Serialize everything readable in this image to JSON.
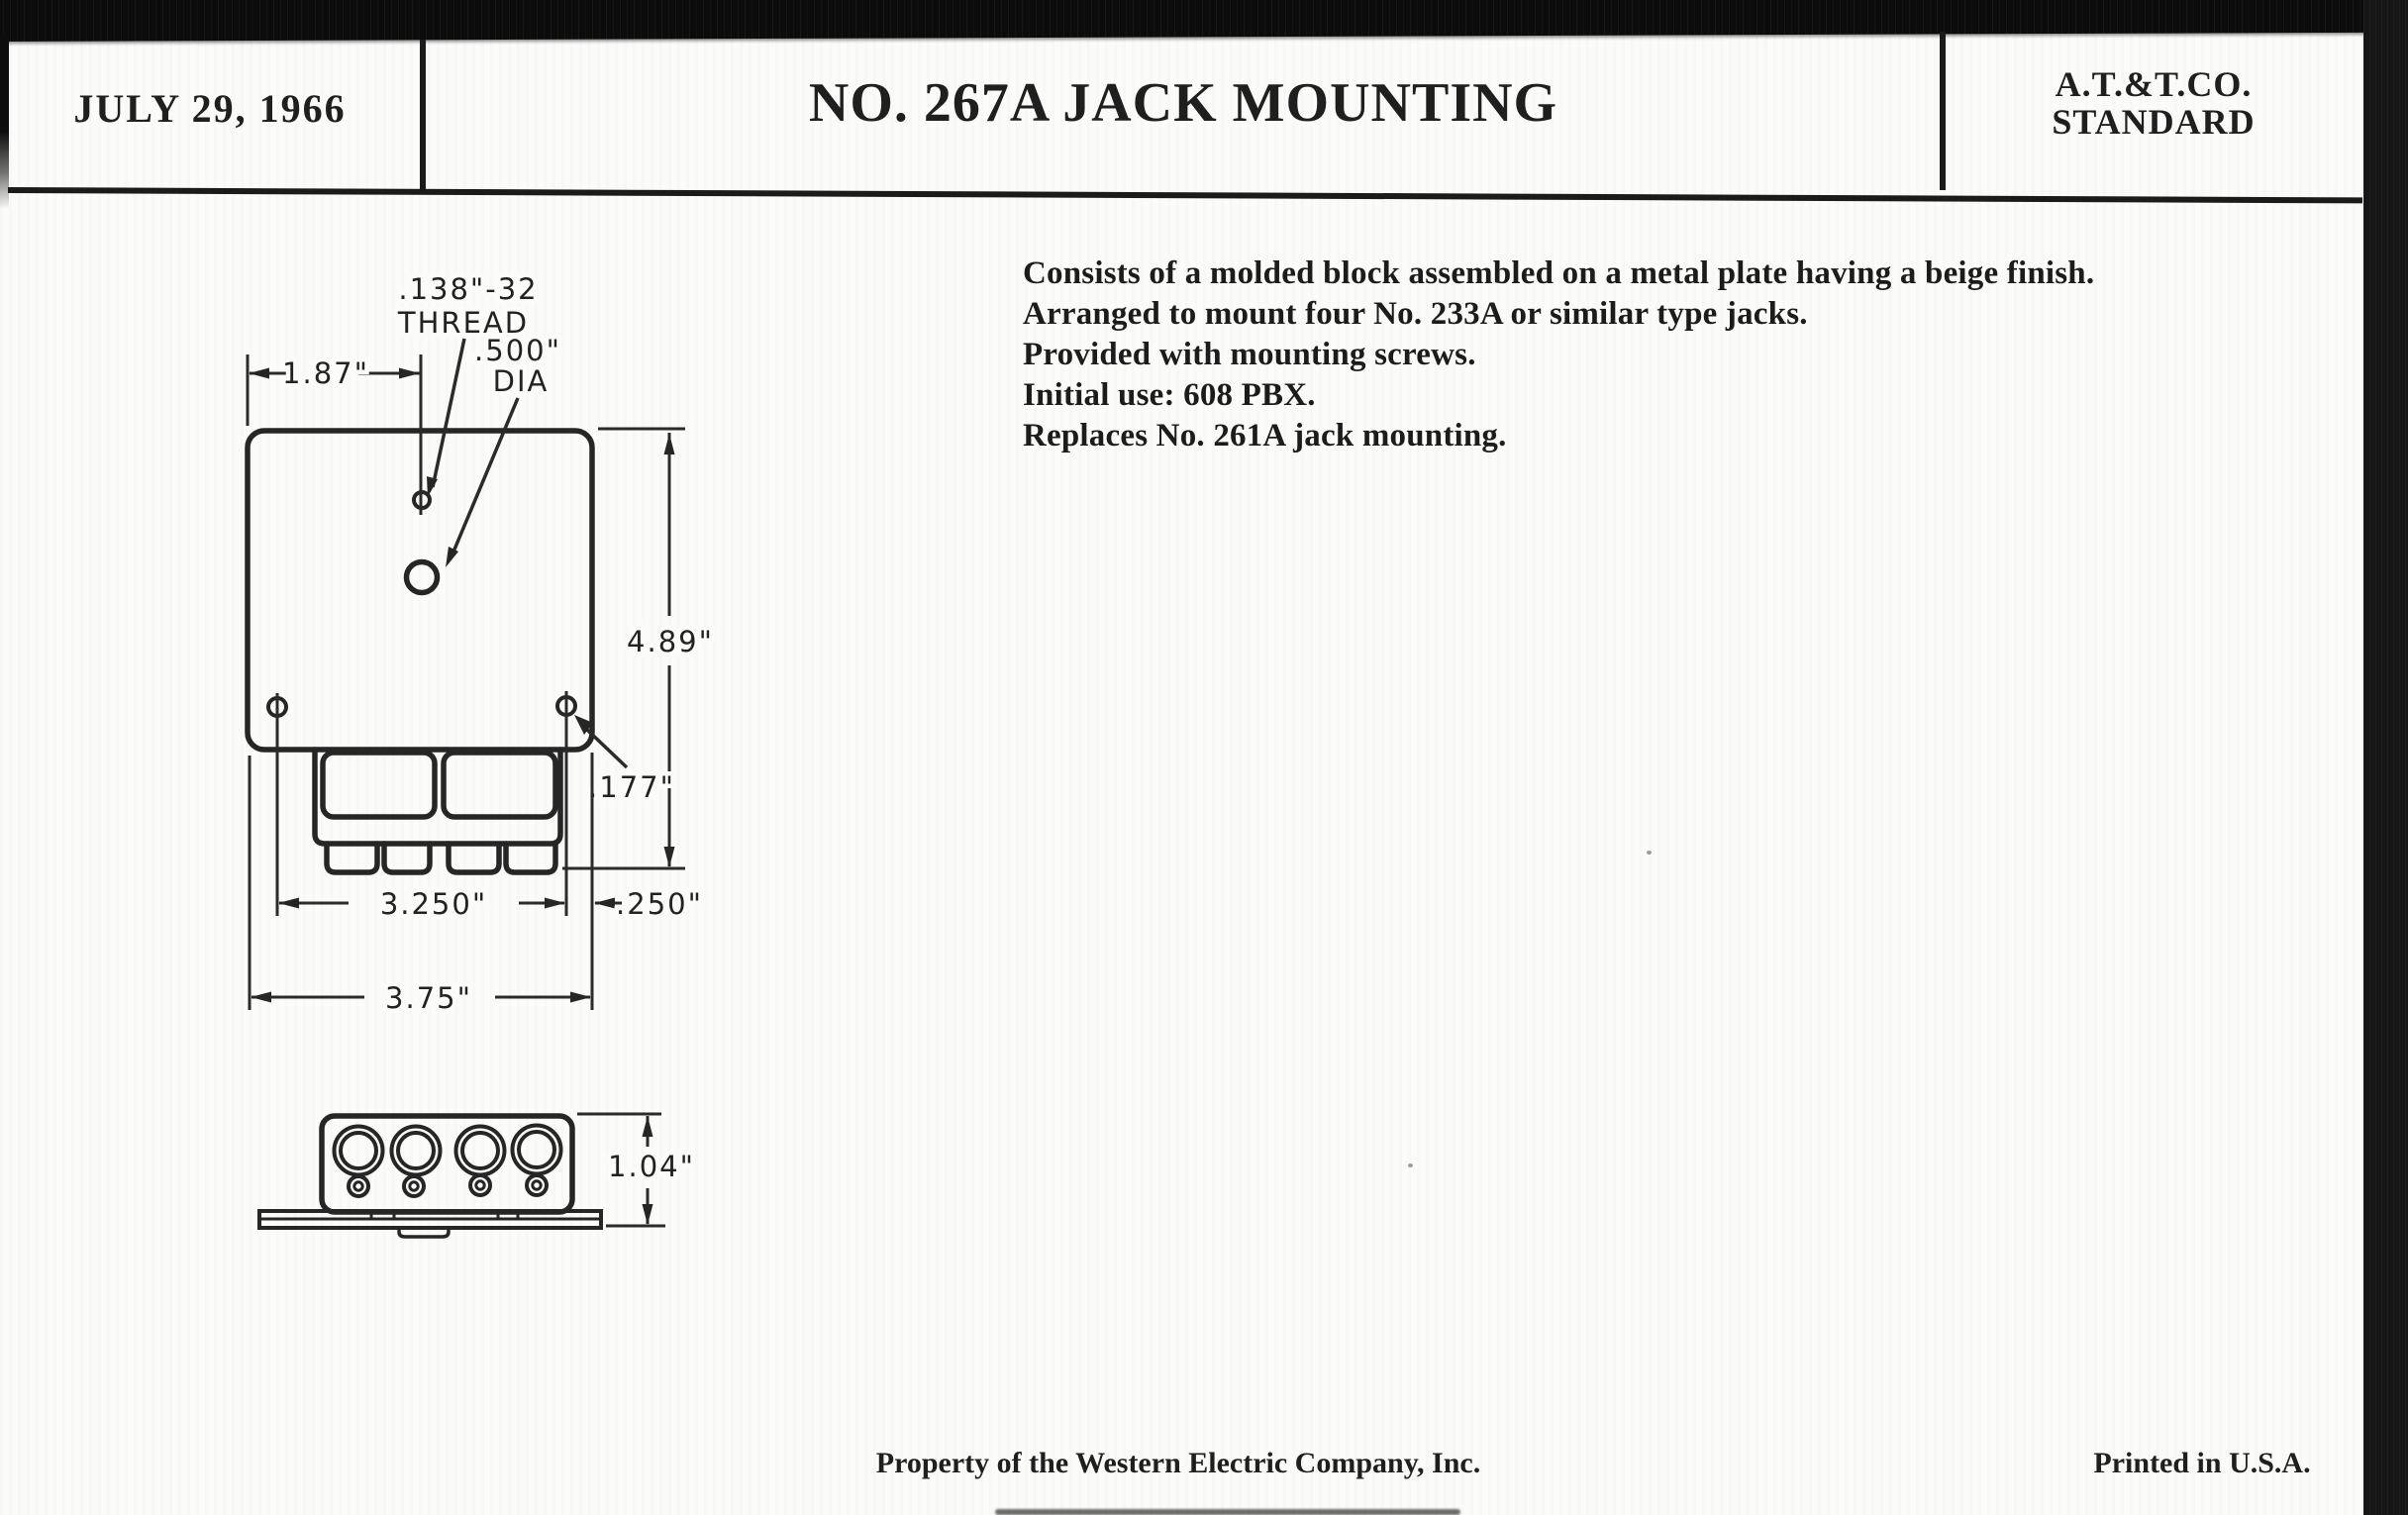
{
  "header": {
    "date": "JULY 29, 1966",
    "title": "NO. 267A JACK MOUNTING",
    "org_line1": "A.T.&T.CO.",
    "org_line2": "STANDARD"
  },
  "description": {
    "lines": [
      "Consists of a molded block assembled on a metal plate having a beige finish.",
      "Arranged to mount four No. 233A or similar type jacks.",
      "Provided with mounting screws.",
      "Initial use:  608 PBX.",
      "Replaces No. 261A jack mounting."
    ]
  },
  "drawing": {
    "front_view": {
      "thread_label_line1": ".138\"-32",
      "thread_label_line2": "THREAD",
      "dia_label_line1": ".500\"",
      "dia_label_line2": "DIA",
      "dim_hole_offset": "1.87\"",
      "dim_height": "4.89\"",
      "dim_screw_hole": ".177\"",
      "dim_block_width": "3.250\"",
      "dim_edge_margin": ".250\"",
      "dim_plate_width": "3.75\""
    },
    "side_view": {
      "dim_height": "1.04\""
    }
  },
  "footer": {
    "property_note": "Property of the Western Electric Company, Inc.",
    "printed_note": "Printed in U.S.A."
  },
  "colors": {
    "ink": "#1f1f1f",
    "paper": "#fbfbf9",
    "scan_band": "#0c0c0c"
  }
}
